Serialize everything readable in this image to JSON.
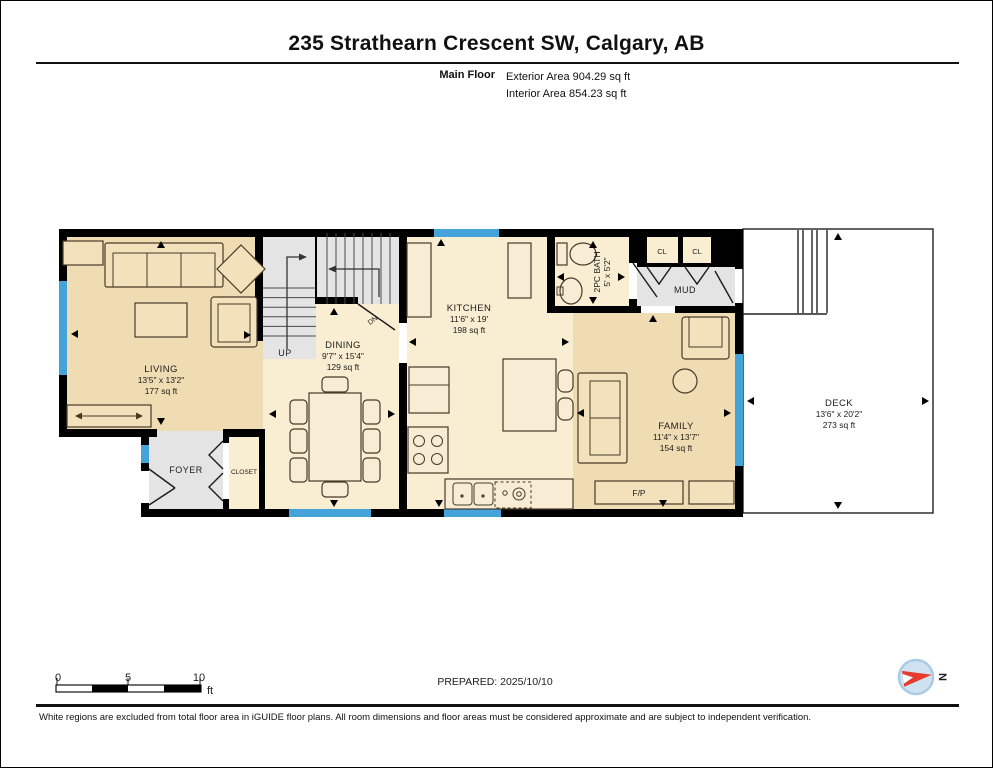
{
  "header": {
    "title": "235 Strathearn Crescent SW, Calgary, AB",
    "floor_label": "Main Floor",
    "exterior_area": "Exterior Area 904.29 sq ft",
    "interior_area": "Interior Area 854.23 sq ft"
  },
  "rooms": {
    "living": {
      "name": "LIVING",
      "dim": "13'5\" x 13'2\"",
      "area": "177 sq ft"
    },
    "dining": {
      "name": "DINING",
      "dim": "9'7\" x 15'4\"",
      "area": "129 sq ft"
    },
    "kitchen": {
      "name": "KITCHEN",
      "dim": "11'6\" x 19'",
      "area": "198 sq ft"
    },
    "family": {
      "name": "FAMILY",
      "dim": "11'4\" x 13'7\"",
      "area": "154 sq ft"
    },
    "deck": {
      "name": "DECK",
      "dim": "13'6\" x 20'2\"",
      "area": "273 sq ft"
    },
    "bath": {
      "name": "2PC BATH",
      "dim": "5' x 5'2\""
    },
    "foyer": {
      "name": "FOYER"
    },
    "closet": {
      "name": "CLOSET"
    },
    "mud": {
      "name": "MUD"
    },
    "cl1": {
      "name": "CL"
    },
    "cl2": {
      "name": "CL"
    },
    "fireplace": {
      "name": "F/P"
    },
    "stairs_up": {
      "name": "UP"
    },
    "stairs_down": {
      "name": "DN"
    }
  },
  "scale_bar": {
    "t0": "0",
    "t5": "5",
    "t10": "10",
    "unit": "ft"
  },
  "prepared_label": "PREPARED: 2025/10/10",
  "compass": {
    "north": "N"
  },
  "footer": {
    "disclaimer": "White regions are excluded from total floor area in iGUIDE floor plans. All room dimensions and floor areas must be considered approximate and are subject to independent verification."
  },
  "colors": {
    "wall": "#000000",
    "window": "#44a3d8",
    "floor_tan": "#f0dcb2",
    "floor_cream": "#f9edd2",
    "floor_gray": "#e4e4e4",
    "deck": "#ffffff",
    "compass_red": "#e63c2f",
    "compass_circle": "#cfe2f1"
  }
}
